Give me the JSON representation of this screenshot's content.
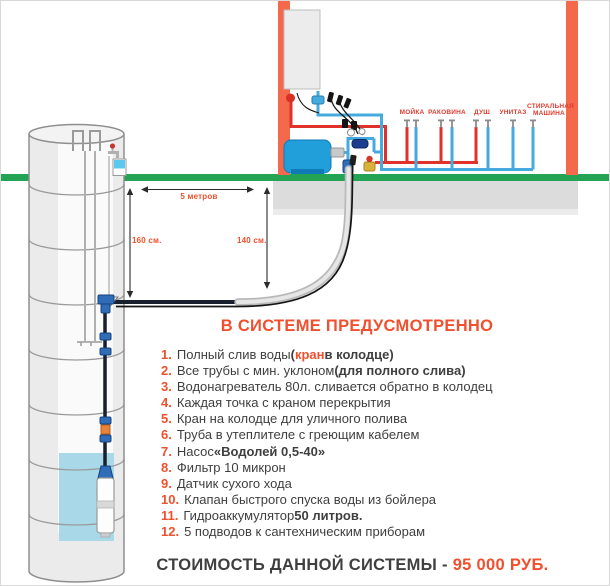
{
  "colors": {
    "accent_orange": "#f0502d",
    "wall_orange": "#f4694b",
    "ground_green": "#23a455",
    "pipe_red": "#e0312a",
    "pipe_blue": "#45aadd",
    "tank_blue": "#219fdb",
    "water_blue": "#a9d8e9",
    "text_dark": "#3f3f3f"
  },
  "diagram": {
    "measurements": {
      "span": "5 метров",
      "left_depth": "160 см.",
      "right_depth": "140 см."
    },
    "fixtures": [
      {
        "label": "МОЙКА"
      },
      {
        "label": "РАКОВИНА"
      },
      {
        "label": "ДУШ"
      },
      {
        "label": "УНИТАЗ"
      },
      {
        "label": "СТИРАЛЬНАЯ МАШИНА"
      }
    ]
  },
  "features": {
    "title": "В СИСТЕМЕ ПРЕДУСМОТРЕННО",
    "items": [
      {
        "num": "1.",
        "parts": [
          {
            "text": "Полный слив воды ",
            "style": "r"
          },
          {
            "text": "(",
            "style": "b"
          },
          {
            "text": "кран",
            "style": "ab"
          },
          {
            "text": " в колодце)",
            "style": "b"
          }
        ]
      },
      {
        "num": "2.",
        "parts": [
          {
            "text": "Все трубы с мин. уклоном ",
            "style": "r"
          },
          {
            "text": "(для полного слива)",
            "style": "b"
          }
        ]
      },
      {
        "num": "3.",
        "parts": [
          {
            "text": "Водонагреватель 80л. сливается обратно в колодец",
            "style": "r"
          }
        ]
      },
      {
        "num": "4.",
        "parts": [
          {
            "text": "Каждая точка с краном перекрытия",
            "style": "r"
          }
        ]
      },
      {
        "num": "5.",
        "parts": [
          {
            "text": "Кран на колодце для уличного полива",
            "style": "r"
          }
        ]
      },
      {
        "num": "6.",
        "parts": [
          {
            "text": "Труба в утеплителе с греющим кабелем",
            "style": "r"
          }
        ]
      },
      {
        "num": "7.",
        "parts": [
          {
            "text": "Насос ",
            "style": "r"
          },
          {
            "text": "«Водолей 0,5-40»",
            "style": "b"
          }
        ]
      },
      {
        "num": "8.",
        "parts": [
          {
            "text": "Фильтр 10 микрон",
            "style": "r"
          }
        ]
      },
      {
        "num": "9.",
        "parts": [
          {
            "text": "Датчик сухого хода",
            "style": "r"
          }
        ]
      },
      {
        "num": "10.",
        "parts": [
          {
            "text": "Клапан быстрого спуска воды из бойлера",
            "style": "r"
          }
        ]
      },
      {
        "num": "11.",
        "parts": [
          {
            "text": "Гидроаккумулятор ",
            "style": "r"
          },
          {
            "text": "50 литров.",
            "style": "b"
          }
        ]
      },
      {
        "num": "12.",
        "parts": [
          {
            "text": "5 подводов к сантехническим приборам",
            "style": "r"
          }
        ]
      }
    ]
  },
  "price": {
    "label": "СТОИМОСТЬ ДАННОЙ СИСТЕМЫ - ",
    "value": "95 000 РУБ."
  }
}
